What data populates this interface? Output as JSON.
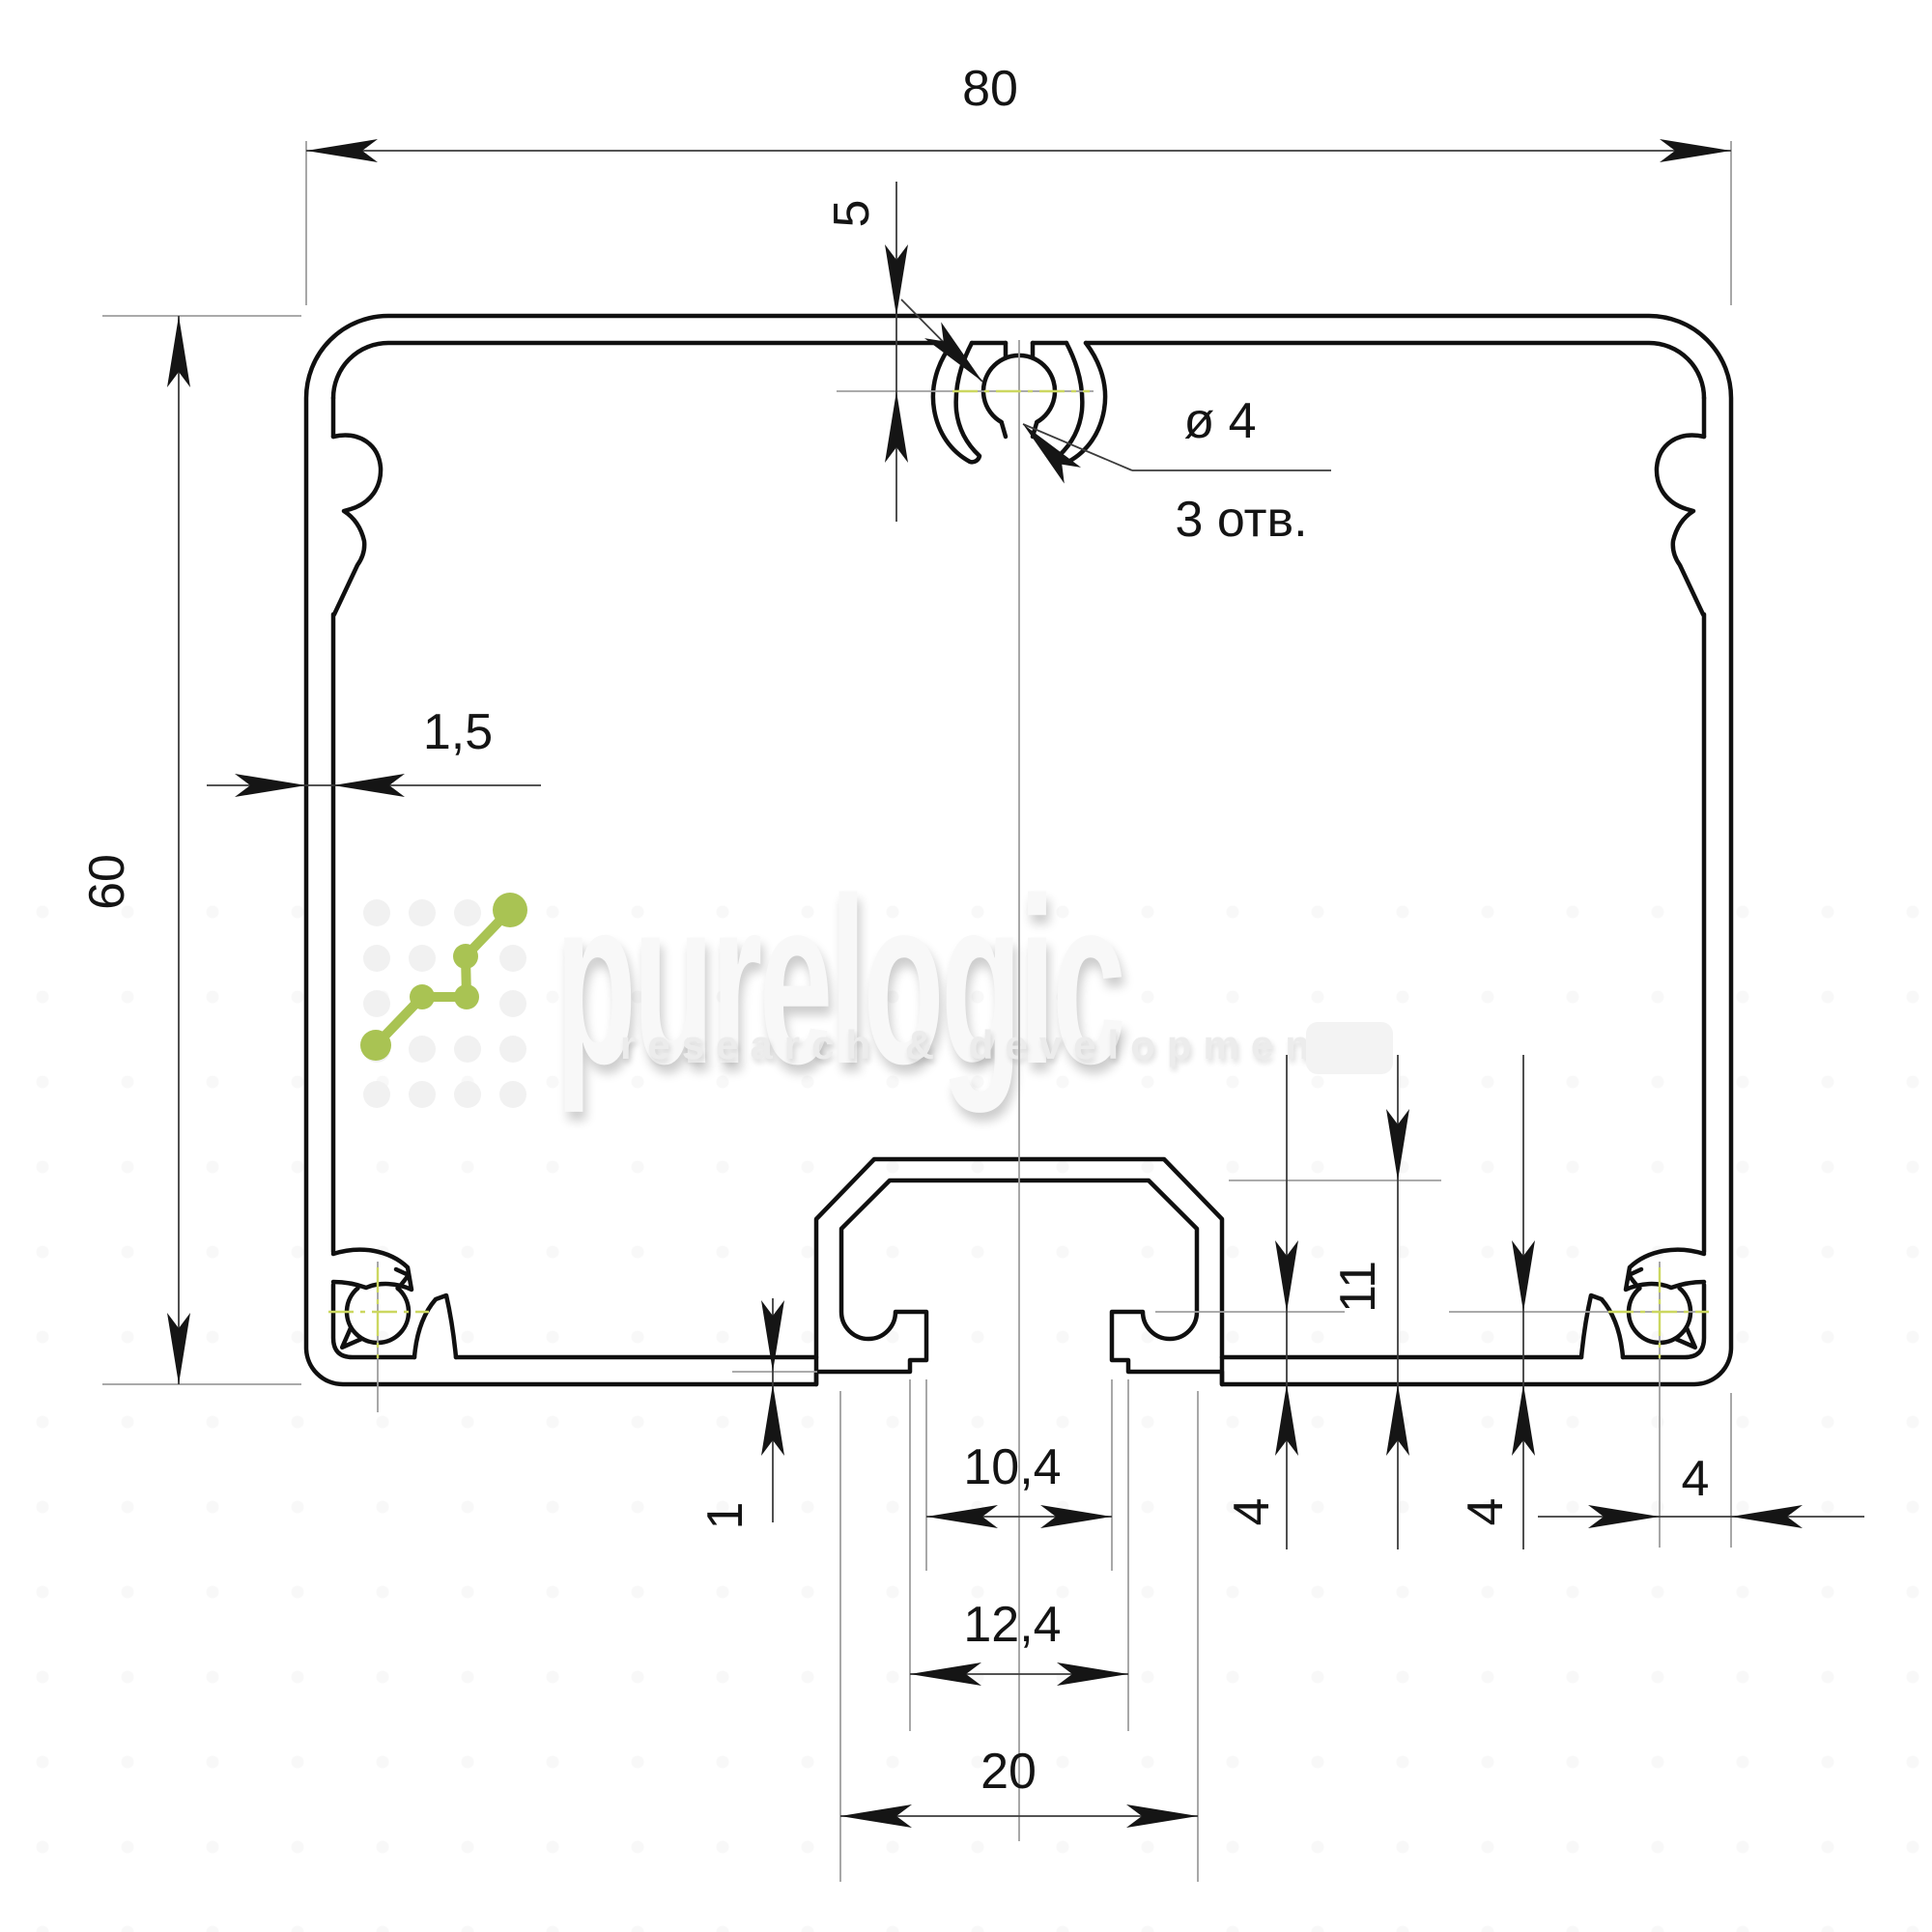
{
  "drawing": {
    "labels": {
      "overall_width": "80",
      "overall_height": "60",
      "wall_thickness": "1,5",
      "top_hole_offset": "5",
      "hole_diameter": "ø 4",
      "holes_note": "3 отв.",
      "slot_depth": "11",
      "lip_height": "4",
      "corner_hole_height": "4",
      "corner_hole_side_offset": "4",
      "bottom_recess": "1",
      "slot_lip_gap": "10,4",
      "slot_opening": "12,4",
      "slot_chamber_width": "20"
    },
    "colors": {
      "outline": "#101010",
      "dim": "#3c3c3c",
      "extension": "#9f9f9f",
      "centerline_accent": "#ccd760",
      "arrow": "#151515"
    }
  },
  "watermark": {
    "wordmark": "purelogic",
    "tagline": "research & development",
    "wordmark_color": "#f8f8f8",
    "tagline_color": "#ececec",
    "logo_color": "#a9c353"
  }
}
